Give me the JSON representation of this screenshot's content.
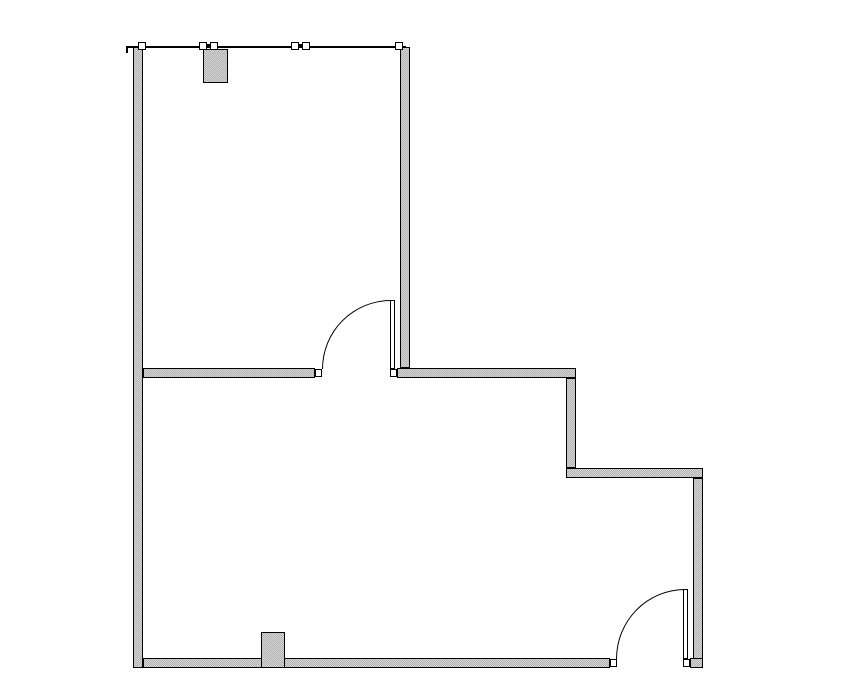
{
  "canvas": {
    "width": 855,
    "height": 678
  },
  "colors": {
    "background": "#ffffff",
    "wall_fill_light": "#d6d6d6",
    "wall_fill_dark": "#b2b2b2",
    "outline": "#000000"
  },
  "walls": [
    {
      "name": "left-exterior-wall",
      "x": 133,
      "y": 47,
      "w": 10,
      "h": 621
    },
    {
      "name": "upper-right-wall",
      "x": 400,
      "y": 47,
      "w": 10,
      "h": 321
    },
    {
      "name": "divider-wall-left",
      "x": 143,
      "y": 368,
      "w": 172,
      "h": 10
    },
    {
      "name": "divider-wall-right",
      "x": 397,
      "y": 368,
      "w": 179,
      "h": 10
    },
    {
      "name": "step-wall-vertical",
      "x": 566,
      "y": 378,
      "w": 10,
      "h": 90
    },
    {
      "name": "step-wall-horizontal",
      "x": 566,
      "y": 468,
      "w": 137,
      "h": 10
    },
    {
      "name": "right-exterior-wall",
      "x": 693,
      "y": 478,
      "w": 10,
      "h": 190
    },
    {
      "name": "bottom-exterior-wall",
      "x": 143,
      "y": 658,
      "w": 467,
      "h": 10
    },
    {
      "name": "bottom-wall-right-stub",
      "x": 690,
      "y": 658,
      "w": 13,
      "h": 10
    }
  ],
  "doors": [
    {
      "name": "upper-room-door",
      "leaf": {
        "x": 390,
        "y": 300,
        "w": 5,
        "h": 69
      },
      "arc": {
        "x": 322,
        "y": 300,
        "w": 69,
        "h": 69
      },
      "jambs": [
        {
          "x": 315,
          "y": 369,
          "w": 7,
          "h": 8
        },
        {
          "x": 390,
          "y": 369,
          "w": 7,
          "h": 8
        }
      ]
    },
    {
      "name": "lower-room-door",
      "leaf": {
        "x": 683,
        "y": 589,
        "w": 5,
        "h": 70
      },
      "arc": {
        "x": 616,
        "y": 589,
        "w": 69,
        "h": 70
      },
      "jambs": [
        {
          "x": 610,
          "y": 659,
          "w": 7,
          "h": 8
        },
        {
          "x": 683,
          "y": 659,
          "w": 7,
          "h": 8
        }
      ]
    }
  ],
  "window_wall": {
    "line": {
      "x": 127,
      "y": 46,
      "w": 279,
      "h": 2
    },
    "end_tick": {
      "x": 126,
      "y": 46,
      "w": 2,
      "h": 7
    },
    "mullion_size": 8,
    "mullion_y": 42,
    "single_mullions_x": [
      138,
      395
    ],
    "paired_mullions_x": [
      [
        199,
        210
      ],
      [
        291,
        302
      ]
    ],
    "connectors": [
      {
        "x": 205,
        "y": 44,
        "w": 10,
        "h": 4
      },
      {
        "x": 297,
        "y": 44,
        "w": 10,
        "h": 4
      }
    ]
  },
  "fixtures": [
    {
      "name": "upper-room-cabinet",
      "x": 203,
      "y": 49,
      "w": 25,
      "h": 34
    },
    {
      "name": "lower-room-cabinet",
      "x": 261,
      "y": 632,
      "w": 24,
      "h": 36
    }
  ]
}
